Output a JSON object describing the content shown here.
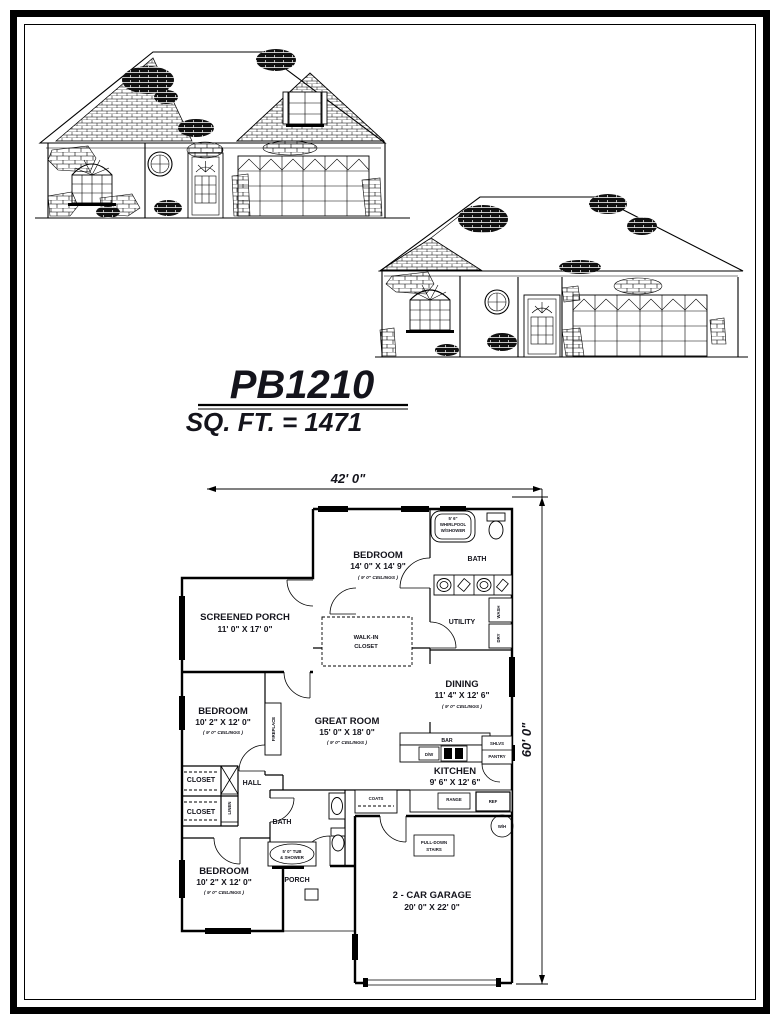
{
  "title_block": {
    "plan_number": "PB1210",
    "square_footage": "SQ. FT. = 1471"
  },
  "dimensions": {
    "overall_width": "42'  0\"",
    "overall_depth": "60'  0\""
  },
  "floor_plan": {
    "master_bedroom": {
      "name": "BEDROOM",
      "size": "14' 0\" X 14' 9\"",
      "ceiling": "( 9' 0\" CEILINGS )"
    },
    "master_bath": {
      "name": "BATH",
      "whirlpool_line1": "5' 6\"",
      "whirlpool_line2": "WHIRLPOOL",
      "whirlpool_line3": "W/SHOWER"
    },
    "utility": {
      "name": "UTILITY",
      "washer": "WASH",
      "dryer": "DRY"
    },
    "screened_porch": {
      "name": "SCREENED PORCH",
      "size": "11' 0\" X 17' 0\""
    },
    "walk_in_closet": {
      "line1": "WALK-IN",
      "line2": "CLOSET"
    },
    "dining": {
      "name": "DINING",
      "size": "11' 4\" X 12' 6\"",
      "ceiling": "( 9' 0\" CEILINGS )"
    },
    "bedroom_2": {
      "name": "BEDROOM",
      "size": "10' 2\" X 12' 0\"",
      "ceiling": "( 9' 0\" CEILINGS )"
    },
    "great_room": {
      "name": "GREAT ROOM",
      "size": "15' 0\" X 18' 0\"",
      "ceiling": "( 9' 0\" CEILINGS )",
      "fireplace": "FIREPLACE"
    },
    "kitchen": {
      "name": "KITCHEN",
      "size": "9' 6\" X 12' 6\"",
      "ceiling": "( 9' 0\" CEILINGS )",
      "bar": "BAR",
      "dishwasher": "D/W",
      "shelves": "SHLVS",
      "pantry": "PANTRY",
      "range": "RANGE",
      "refrigerator": "REF"
    },
    "hall": {
      "name": "HALL",
      "closet_1": "CLOSET",
      "closet_2": "CLOSET",
      "linen": "LINEN"
    },
    "bath_2": {
      "name": "BATH",
      "tub_line1": "5' 0\" TUB",
      "tub_line2": "& SHOWER"
    },
    "coats": "COATS",
    "bedroom_3": {
      "name": "BEDROOM",
      "size": "10' 2\" X 12' 0\"",
      "ceiling": "( 9' 0\" CEILINGS )"
    },
    "porch": {
      "name": "PORCH"
    },
    "garage": {
      "name": "2 - CAR GARAGE",
      "size": "20' 0\" X 22' 0\"",
      "stairs_line1": "PULL-DOWN",
      "stairs_line2": "STAIRS",
      "water_heater": "W/H"
    }
  }
}
